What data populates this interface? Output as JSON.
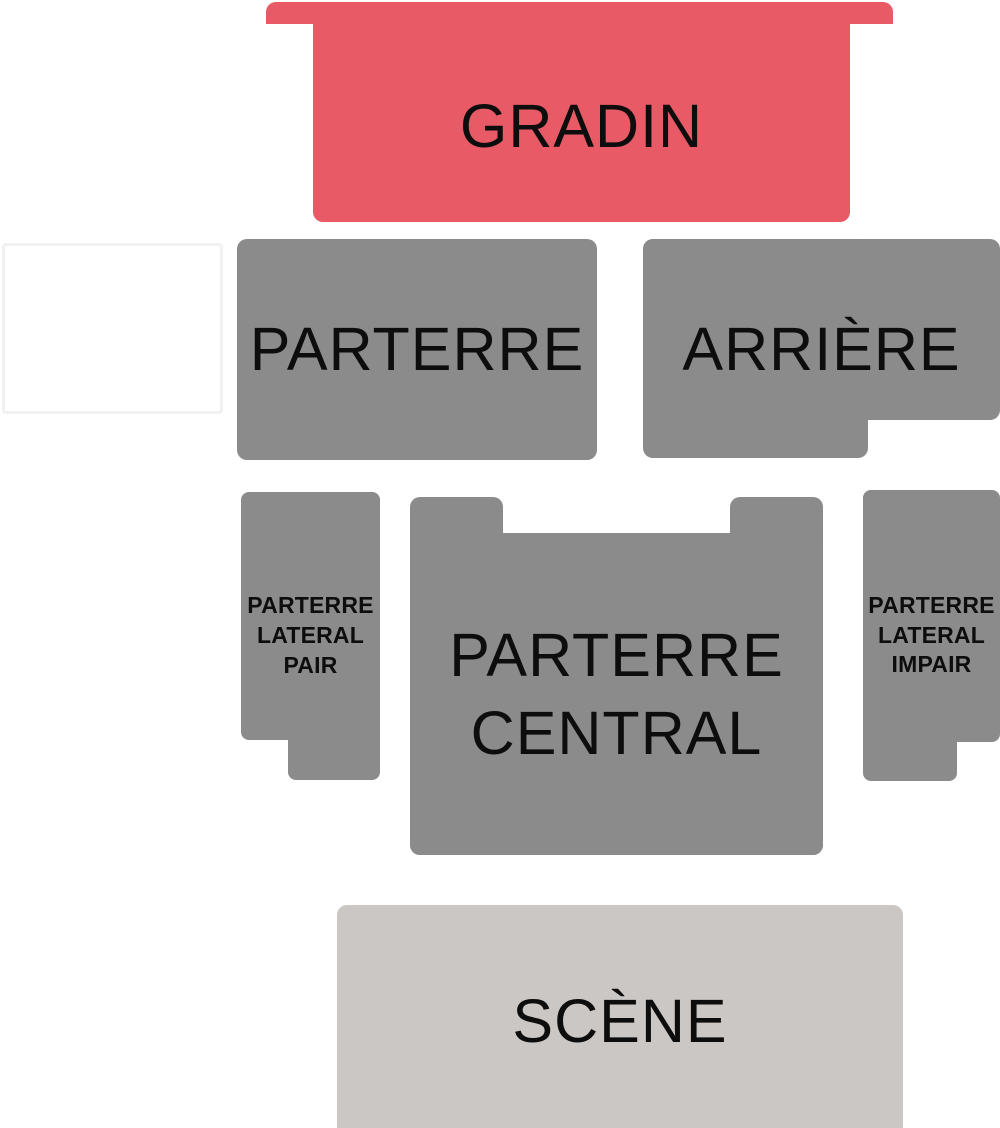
{
  "canvas": {
    "width": 1000,
    "height": 1128,
    "background": "#ffffff"
  },
  "colors": {
    "tier_red": "#e85a66",
    "section_gray": "#8b8b8b",
    "stage_gray": "#cac7c5",
    "empty_block_border": "#f1f1f1",
    "label_text": "#0d0d0d"
  },
  "sections": {
    "gradin": {
      "label": "GRADIN"
    },
    "parterre": {
      "label": "PARTERRE"
    },
    "arriere": {
      "label": "ARRIÈRE"
    },
    "parterre_lateral_pair": {
      "label": "PARTERRE LATERAL PAIR"
    },
    "parterre_central": {
      "label": "PARTERRE CENTRAL"
    },
    "parterre_lateral_impair": {
      "label": "PARTERRE LATERAL IMPAIR"
    },
    "scene": {
      "label": "SCÈNE"
    },
    "empty_block": {
      "label": ""
    }
  }
}
